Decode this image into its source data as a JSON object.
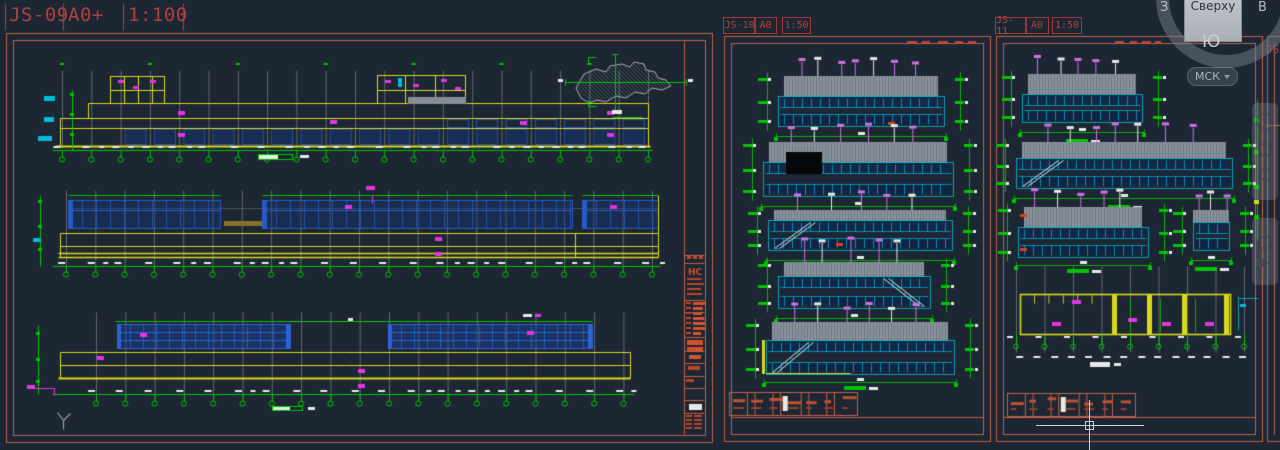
{
  "app": {
    "background": "#1c2733"
  },
  "palette": {
    "frame": "#c06048",
    "label_red": "#b04040",
    "red_fill": "#c4502c",
    "yellow": "#d9d91c",
    "green": "#00c400",
    "cyan": "#00bcd8",
    "blue": "#2a5fd0",
    "blue_fill": "rgba(20,56,130,0.40)",
    "magenta": "#e434e4",
    "violet": "#cf72e2",
    "gray_grid": "#7e848d",
    "gray_hatch": "#8b939c",
    "white": "#e8e8e8",
    "cursor": "#cfcfcf"
  },
  "sheet_labels": [
    {
      "id": "JS-09",
      "paper": "A0+",
      "scale": "1:100"
    },
    {
      "id": "JS-10",
      "paper": "A0",
      "scale": "1:50"
    },
    {
      "id": "JS-11",
      "paper": "A0",
      "scale": "1:50"
    }
  ],
  "partial_sheet_label": "JS-",
  "viewcube": {
    "face_label": "Сверху",
    "compass": {
      "west": "З",
      "east": "В",
      "south": "Ю"
    }
  },
  "ucs_selector": {
    "label": "МСК"
  },
  "title_block": {
    "logo": "НС"
  },
  "navbar_icons": [
    "navigation-wheel",
    "pan",
    "zoom",
    "orbit",
    "showmotion"
  ]
}
